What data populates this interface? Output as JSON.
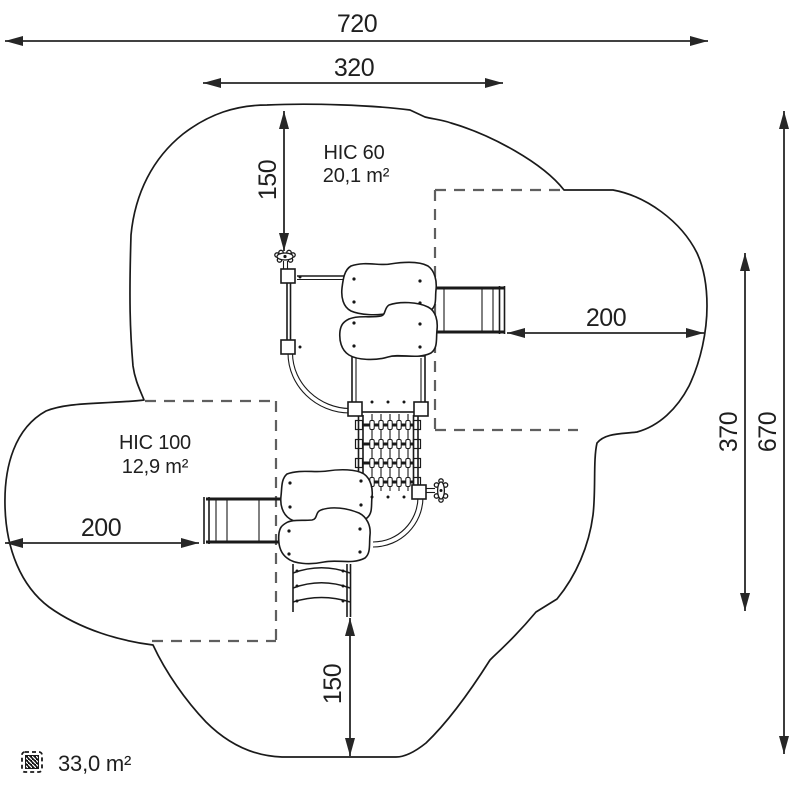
{
  "drawing": {
    "type": "playground-safety-area-plan",
    "dimensions": {
      "overall_width": "720",
      "platform_width": "320",
      "top_clearance": "150",
      "right_slide_clearance": "200",
      "right_inner_height": "370",
      "overall_height": "670",
      "left_slide_clearance": "200",
      "bottom_clearance": "150"
    },
    "zones": {
      "hic60": {
        "label": "HIC 60",
        "area": "20,1 m²"
      },
      "hic100": {
        "label": "HIC 100",
        "area": "12,9 m²"
      }
    },
    "legend": {
      "total_area": "33,0 m²",
      "icon": "hatched-area-icon"
    },
    "colors": {
      "line": "#1a1a1a",
      "dash": "#5f5f5f",
      "background": "#ffffff"
    }
  }
}
